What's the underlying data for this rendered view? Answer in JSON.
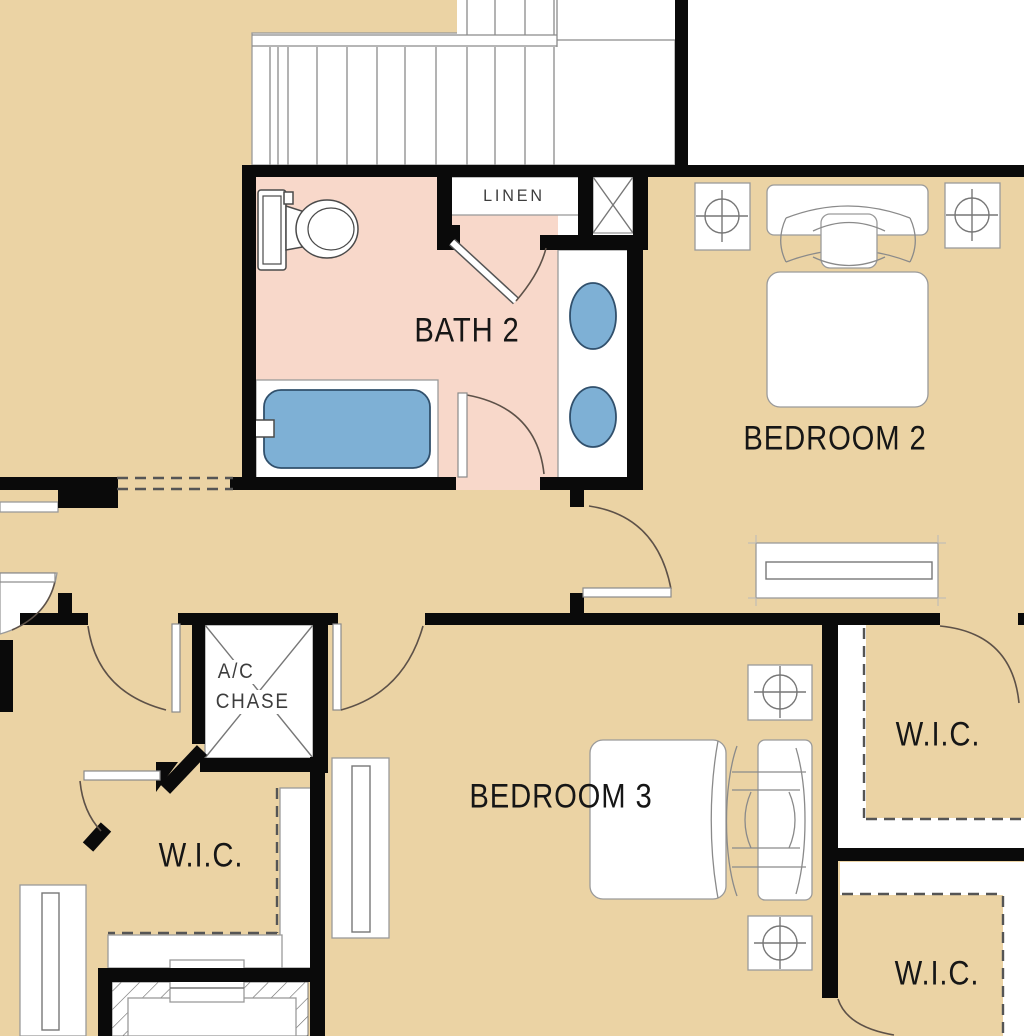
{
  "plan_title": "Second floor plan detail",
  "rooms": {
    "bath2": {
      "label": "BATH 2"
    },
    "bedroom2": {
      "label": "BEDROOM 2"
    },
    "bedroom3": {
      "label": "BEDROOM 3"
    },
    "wic_left": {
      "label": "W.I.C."
    },
    "wic_upper_right": {
      "label": "W.I.C."
    },
    "wic_lower_right": {
      "label": "W.I.C."
    },
    "linen": {
      "label": "LINEN"
    },
    "ac_chase": {
      "line1": "A/C",
      "line2": "CHASE"
    }
  },
  "colors": {
    "floor_tan": "#ebd3a4",
    "bath_pink": "#f8d8ca",
    "fixture_blue": "#7eb0d5",
    "wall_black": "#0a0a0a",
    "line_gray": "#8a8a8a",
    "arc_brown": "#5d5148",
    "text_dark": "#161616",
    "text_gray": "#3d3d3d"
  }
}
